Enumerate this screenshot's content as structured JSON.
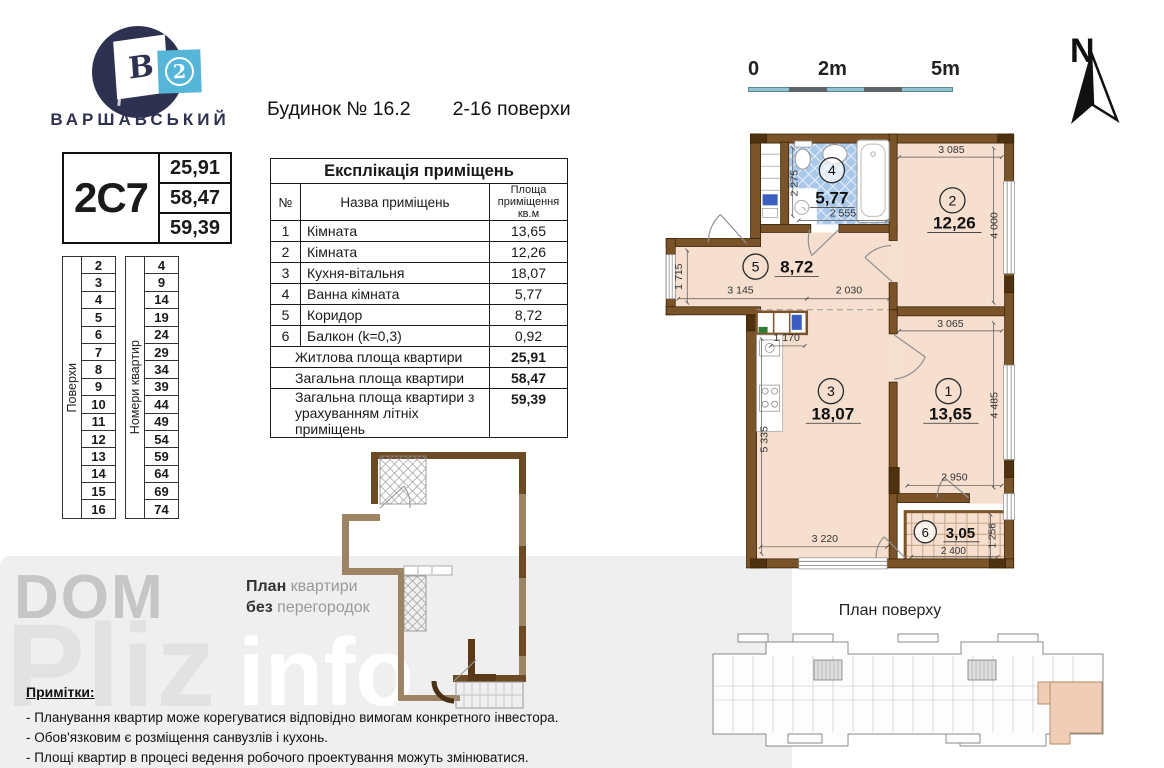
{
  "logo": {
    "flag_letter": "В",
    "flag_number": "2",
    "brand": "ВАРШАВСЬКИЙ"
  },
  "apartment": {
    "code": "2C7",
    "living_area": "25,91",
    "total_area": "58,47",
    "total_area_summer": "59,39"
  },
  "floors_table": {
    "col1_label": "Поверхи",
    "col2_label": "Номери квартир",
    "floors": [
      "2",
      "3",
      "4",
      "5",
      "6",
      "7",
      "8",
      "9",
      "10",
      "11",
      "12",
      "13",
      "14",
      "15",
      "16"
    ],
    "apartments": [
      "4",
      "9",
      "14",
      "19",
      "24",
      "29",
      "34",
      "39",
      "44",
      "49",
      "54",
      "59",
      "64",
      "69",
      "74"
    ]
  },
  "header": {
    "building": "Будинок № 16.2",
    "floors_range": "2-16 поверхи"
  },
  "explication": {
    "title": "Експлікація приміщень",
    "col_no": "№",
    "col_name": "Назва приміщень",
    "col_area": "Площа\nприміщення\nкв.м",
    "rows": [
      {
        "no": "1",
        "name": "Кімната",
        "area": "13,65"
      },
      {
        "no": "2",
        "name": "Кімната",
        "area": "12,26"
      },
      {
        "no": "3",
        "name": "Кухня-вітальня",
        "area": "18,07"
      },
      {
        "no": "4",
        "name": "Ванна кімната",
        "area": "5,77"
      },
      {
        "no": "5",
        "name": "Коридор",
        "area": "8,72"
      },
      {
        "no": "6",
        "name": "Балкон (k=0,3)",
        "area": "0,92"
      }
    ],
    "summary": [
      {
        "label": "Житлова площа квартири",
        "value": "25,91"
      },
      {
        "label": "Загальна площа квартири",
        "value": "58,47"
      },
      {
        "label": "Загальна площа квартири з урахуванням літніх приміщень",
        "value": "59,39"
      }
    ]
  },
  "scale": {
    "t0": "0",
    "t2m": "2m",
    "t5m": "5m"
  },
  "north": {
    "label": "N"
  },
  "plan": {
    "rooms": {
      "r1": {
        "num": "1",
        "area": "13,65"
      },
      "r2": {
        "num": "2",
        "area": "12,26"
      },
      "r3": {
        "num": "3",
        "area": "18,07"
      },
      "r4": {
        "num": "4",
        "area": "5,77"
      },
      "r5": {
        "num": "5",
        "area": "8,72"
      },
      "r6": {
        "num": "6",
        "area": "3,05"
      }
    },
    "dims": {
      "room2_top": "3 085",
      "room2_right": "4 000",
      "bath_v": "2 275",
      "bath_h": "2 555",
      "hall_v": "1 715",
      "hall_h1": "3 145",
      "hall_h2": "2 030",
      "kitchen_top": "1 170",
      "kitchen_v": "5 335",
      "room1_top": "3 065",
      "room1_right": "4 485",
      "room1_bottom": "2 950",
      "room3_bottom": "3 220",
      "balcony_h": "2 400",
      "balcony_v": "1 256"
    }
  },
  "small_plan": {
    "b1": "План",
    "g1": " квартири",
    "b2": "без",
    "g2": " перегородок"
  },
  "floor_plan": {
    "title": "План поверху"
  },
  "notes": {
    "title": "Примітки:",
    "items": [
      "- Планування квартир може корегуватися відповідно вимогам конкретного інвестора.",
      "- Обов'язковим є розміщення санвузлів і кухонь.",
      "- Площі квартир в процесі ведення робочого проектування можуть змінюватися."
    ]
  },
  "watermark": {
    "l1": "DOM",
    "l2": "Pliz",
    "l3": "info"
  },
  "colors": {
    "wall_brown": "#7a5428",
    "floor_salmon": "#f6dfcf",
    "tile_blue": "#aac8e9",
    "logo_navy": "#2e3150",
    "logo_blue": "#56b6d9",
    "scale_teal": "#8fc3cf",
    "highlight": "#f0cdb6"
  }
}
